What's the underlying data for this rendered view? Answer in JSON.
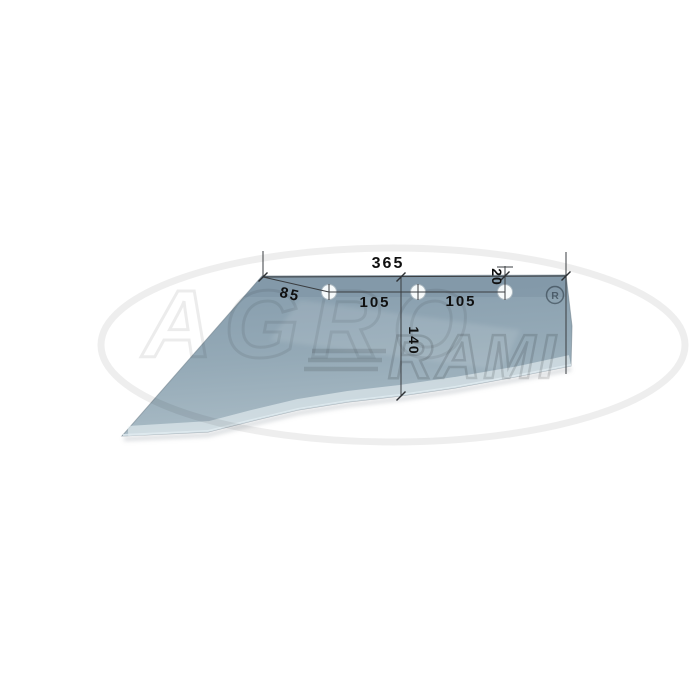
{
  "figure": {
    "description_label": "",
    "dimensions": {
      "overall_width": "365",
      "edge_to_first_hole": "85",
      "hole_spacing_left": "105",
      "hole_spacing_right": "105",
      "top_edge_to_hole_line": "20",
      "mid_height": "140"
    },
    "watermark": {
      "brand_line1": "AGRO",
      "brand_line2": "RAMI",
      "registered_mark": "®",
      "registered_letter": "R"
    },
    "colors": {
      "background": "#ffffff",
      "blade_top": "#8ba1b0",
      "blade_mid": "#97acb9",
      "blade_bottom": "#a9bcc6",
      "blade_bevel": "#c3d1d9",
      "dimension_line": "#3a3d40",
      "label_text": "#101010",
      "watermark_gray": "#e6e6e6"
    },
    "hole_count": "3"
  }
}
